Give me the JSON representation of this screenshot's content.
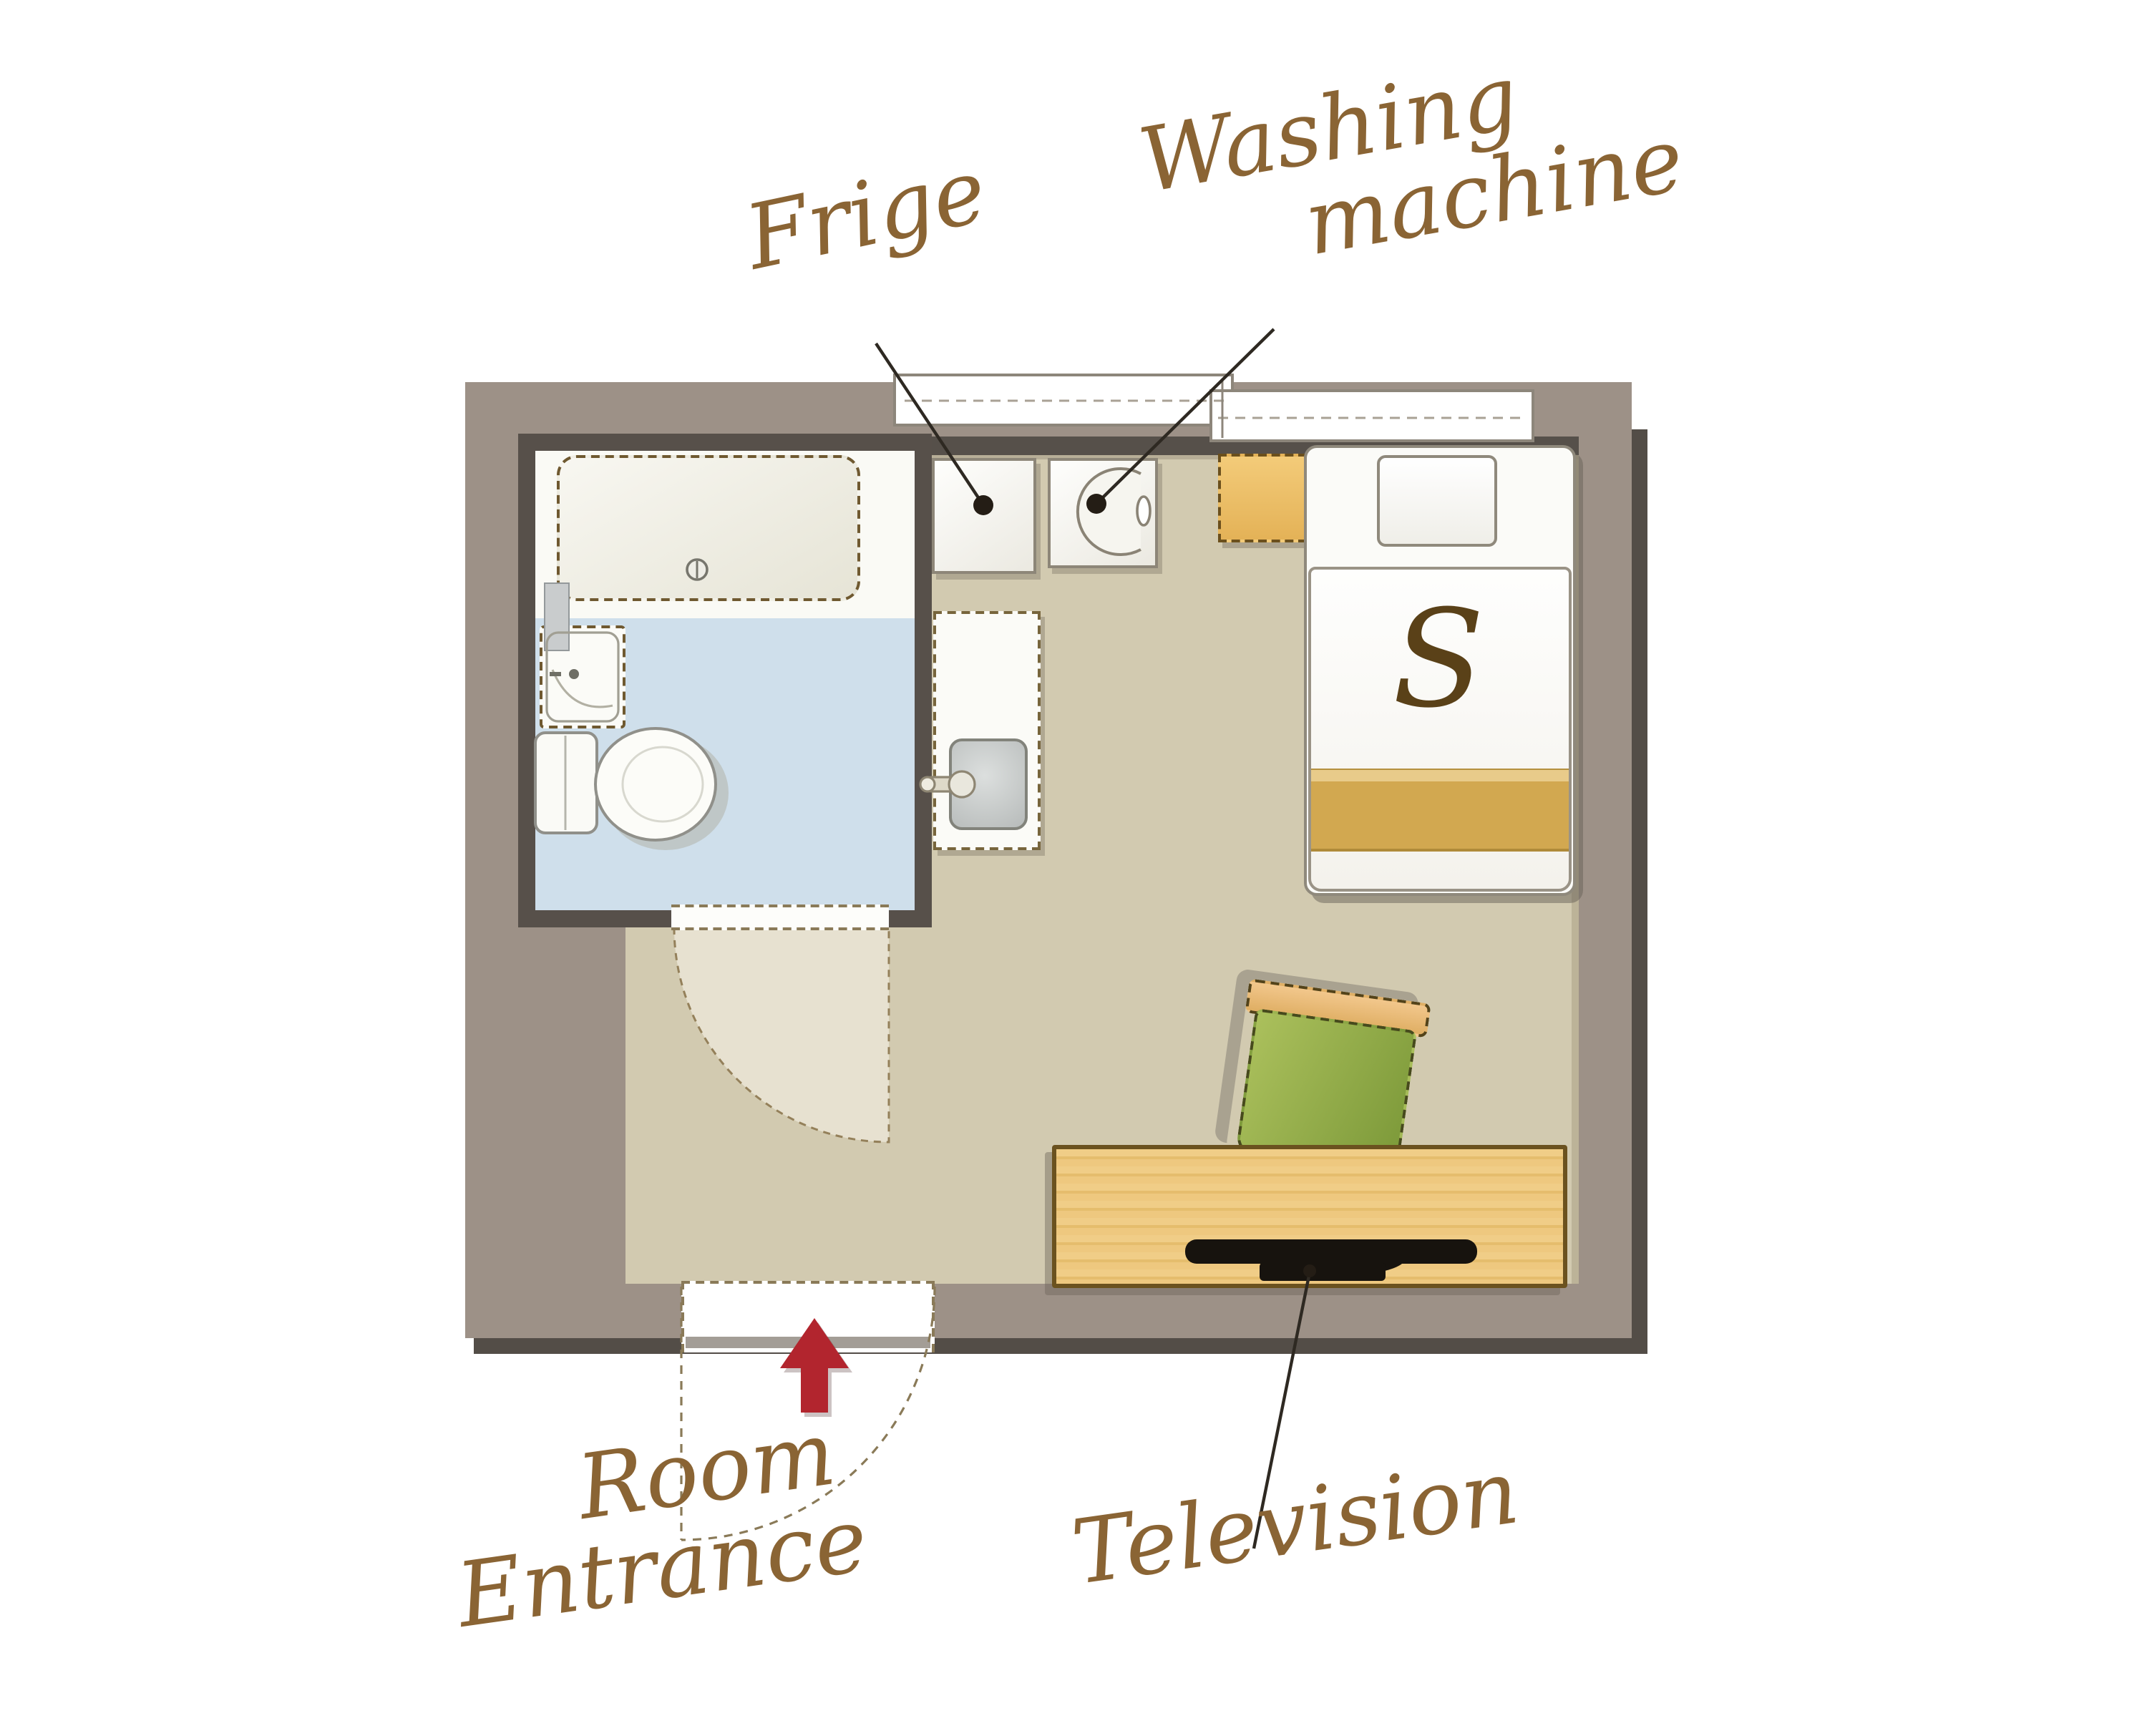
{
  "title": "Single room floor plan",
  "labels": {
    "fridge": "Frige",
    "washing_line1": "Washing",
    "washing_line2": "machine",
    "entrance_line1": "Room",
    "entrance_line2": "Entrance",
    "television": "Television"
  },
  "bed": {
    "letter": "S"
  },
  "colors": {
    "wall": "#9d9187",
    "wall_shadow": "#534d47",
    "floor": "#d2cab0",
    "bathroom_floor": "#cfdfeb",
    "door_swing": "#e7e1d0",
    "desk_wood": "#edc87f",
    "nightstand_wood": "#ecbf66",
    "chair_green": "#8fae47",
    "bed_band_gold": "#d2a850",
    "label_brown": "#8a6434",
    "arrow_red": "#b2252e",
    "tv_black": "#17130e"
  }
}
